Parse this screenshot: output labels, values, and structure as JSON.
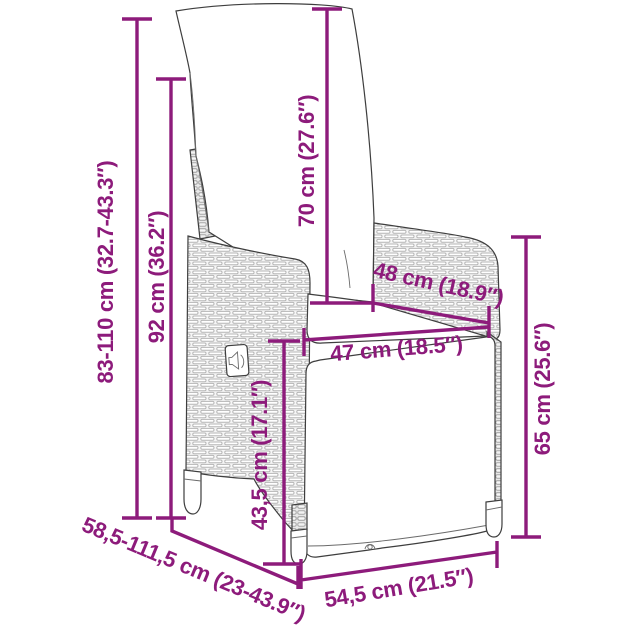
{
  "diagram": {
    "description": "Dimension diagram line drawing of a reclining rattan garden chair with cushions",
    "accent_color": "#8D1B7B",
    "outline_color": "#3E3E3E",
    "rattan_color": "#b9b9b9",
    "dimensions": [
      {
        "id": "height-range",
        "label": "83-110 cm (32.7-43.3″)"
      },
      {
        "id": "overall-height",
        "label": "92 cm (36.2″)"
      },
      {
        "id": "backrest-height",
        "label": "70 cm (27.6″)"
      },
      {
        "id": "seat-depth",
        "label": "48 cm (18.9″)"
      },
      {
        "id": "seat-width",
        "label": "47 cm (18.5″)"
      },
      {
        "id": "side-height",
        "label": "65 cm (25.6″)"
      },
      {
        "id": "seat-height",
        "label": "43,5 cm (17.1″)"
      },
      {
        "id": "depth-range",
        "label": "58,5-111,5 cm (23-43.9″)"
      },
      {
        "id": "front-width",
        "label": "54,5 cm (21.5″)"
      }
    ]
  }
}
